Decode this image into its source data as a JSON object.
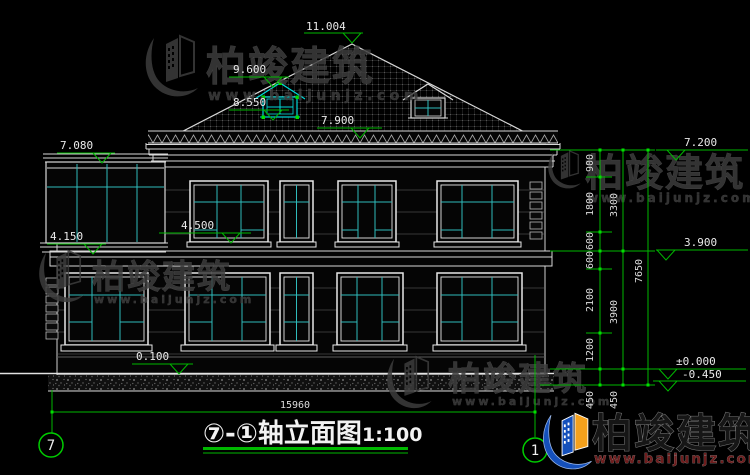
{
  "drawing": {
    "title": "⑦-①轴立面图",
    "scale": "1:100",
    "axis_left": "7",
    "axis_right": "1",
    "total_width_dim": "15960"
  },
  "elevation_markers": [
    {
      "label": "11.004"
    },
    {
      "label": "9.600"
    },
    {
      "label": "8.550"
    },
    {
      "label": "7.900"
    },
    {
      "label": "7.080"
    },
    {
      "label": "4.500"
    },
    {
      "label": "4.150"
    },
    {
      "label": "0.100"
    },
    {
      "label": "7.200"
    },
    {
      "label": "3.900"
    },
    {
      "label": "±0.000"
    },
    {
      "label": "-0.450"
    }
  ],
  "right_dims": [
    {
      "label": "900"
    },
    {
      "label": "1800"
    },
    {
      "label": "600"
    },
    {
      "label": "600"
    },
    {
      "label": "2100"
    },
    {
      "label": "1200"
    },
    {
      "label": "450"
    },
    {
      "label": "3300"
    },
    {
      "label": "3900"
    },
    {
      "label": "450"
    },
    {
      "label": "7650"
    }
  ],
  "watermark": {
    "brand": "柏竣建筑",
    "site": "www.baijunjz.com"
  },
  "colors": {
    "dim_green": "#00b800",
    "selection_cyan": "#00d9d9",
    "mullion_teal": "#2fbbbb",
    "line_white": "#d8d8d8",
    "logo_blue": "#1550bb",
    "logo_orange": "#f5a11c"
  }
}
